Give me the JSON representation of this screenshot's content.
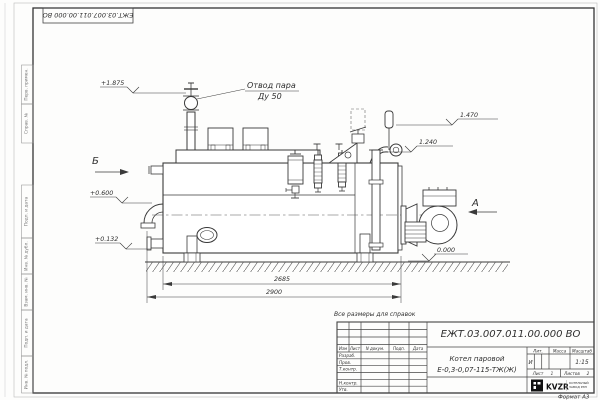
{
  "sheet": {
    "format_note": "Формат А3",
    "reference_note": "Все размеры для справок"
  },
  "doc": {
    "number": "ЕЖТ.03.007.011.00.000 ВО",
    "name_line1": "Котел паровой",
    "name_line2": "Е-0,3-0,07-115-ТЖ(Ж)"
  },
  "title_block": {
    "header_cols": {
      "izm": "Изм",
      "list": "Лист",
      "doc": "N докум.",
      "sign": "Подп.",
      "date": "Дата"
    },
    "rows": [
      "Разраб.",
      "Пров.",
      "Т.контр.",
      "",
      "Н.контр.",
      "Утв."
    ],
    "lit_label": "Лит.",
    "lit_value": "И",
    "mass_label": "Масса",
    "scale_label": "Масштаб",
    "scale_value": "1:15",
    "sheet_label": "Лист",
    "sheet_number": "1",
    "sheets_label": "Листов",
    "sheets_total": "2",
    "logo_text": "KVZR",
    "logo_sub1": "КОТЕЛЬНЫЙ",
    "logo_sub2": "ЗАВОД РЭП"
  },
  "margin_labels": [
    "Перв. примен.",
    "Справ. №",
    "Подп. и дата",
    "Инв. № дубл.",
    "Взам. инв. №",
    "Подп. и дата",
    "Инв. № подл."
  ],
  "annotations": {
    "steam_outlet_1": "Отвод пара",
    "steam_outlet_2": "Ду 50",
    "view_a": "А",
    "view_b": "Б",
    "elev_top": "+1.875",
    "elev_right_upper": "1.470",
    "elev_right_lower": "1.240",
    "elev_left_mid": "+0.600",
    "elev_left_low": "+0.132",
    "elev_zero": "0.000"
  },
  "dimensions": {
    "inner_length": "2685",
    "overall_length": "2900"
  }
}
